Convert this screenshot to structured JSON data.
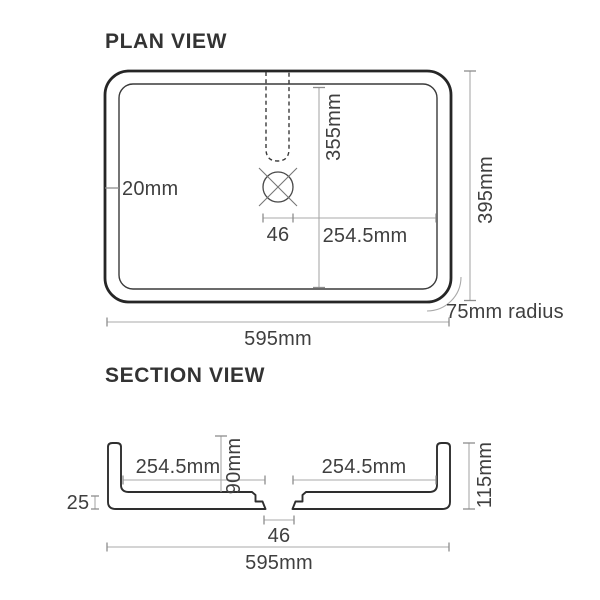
{
  "plan_view": {
    "title": "PLAN VIEW",
    "dimensions": {
      "wall_thickness": "20mm",
      "bowl_length": "355mm",
      "drain_width": "46",
      "drain_to_wall": "254.5mm",
      "overall_depth": "395mm",
      "corner_radius": "75mm radius",
      "overall_width": "595mm"
    }
  },
  "section_view": {
    "title": "SECTION VIEW",
    "dimensions": {
      "left_to_drain": "254.5mm",
      "bowl_depth": "90mm",
      "drain_to_right": "254.5mm",
      "overall_height": "115mm",
      "base_thickness": "25",
      "drain_width": "46",
      "overall_width": "595mm"
    }
  },
  "colors": {
    "background": "#ffffff",
    "outline": "#262626",
    "thin_line": "#3a3a3a",
    "dimension_line": "#a9a9a9",
    "text": "#3f3f3f"
  }
}
